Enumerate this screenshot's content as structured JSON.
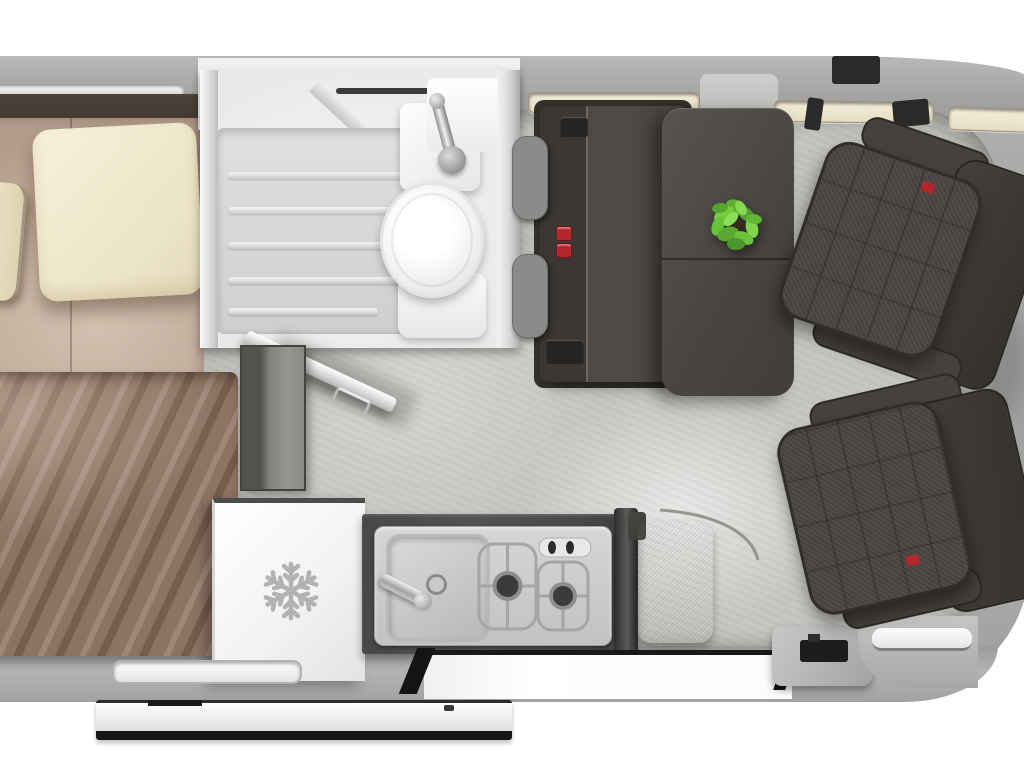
{
  "meta": {
    "title": "Campervan interior floor plan - top-down 3D render",
    "view": "top-down",
    "visible_text": "none"
  },
  "colors": {
    "bg": "#ffffff",
    "body_grey": "#a6a6a4",
    "floor": "#c6c6c2",
    "bathroom_white": "#eceae8",
    "bed_tan": "#b29c8c",
    "blanket_brown": "#8d7363",
    "pillow_cream": "#f2ebd2",
    "headboard_brown": "#41382f",
    "charcoal_dark": "#3a3735",
    "headrest_grey": "#8d8b89",
    "counter_dark": "#4b4947",
    "steel": "#c6c6c4",
    "buckle_red": "#b5252c",
    "plant_green": "#6abf3a",
    "snowflake_grey": "#b3b2b0",
    "door_trim_black": "#1b1917"
  },
  "labels": {
    "vehicle": "campervan body shell",
    "floor": "interior floor",
    "bed": "rear double bed",
    "headboard": "bed headboard",
    "pillow": "pillow",
    "blanket": "blanket",
    "bathroom": "wet room",
    "shower": "shower tray",
    "toilet": "toilet",
    "basin": "washbasin with faucet",
    "bath_door": "open bathroom door",
    "partition": "bed-end partition panel",
    "fridge": "refrigerator (snowflake icon)",
    "counter": "kitchen worktop",
    "sink": "kitchen sink",
    "hob": "two-burner gas hob",
    "bench": "worktop end cushion",
    "sofa": "two-seat travel sofa",
    "headrest": "sofa headrest",
    "buckle": "seat-belt buckle",
    "table": "dinette table",
    "plant": "potted plant",
    "passenger_seat": "passenger swivel seat",
    "driver_seat": "driver swivel seat",
    "entry": "sliding-door opening",
    "door_panel": "sliding door panel",
    "window": "window slit",
    "step": "entry step trim"
  },
  "zones": [
    {
      "name": "bedroom",
      "contents": [
        "double bed",
        "two pillows",
        "blanket",
        "headboard"
      ]
    },
    {
      "name": "bathroom",
      "contents": [
        "shower tray",
        "toilet",
        "washbasin",
        "chrome faucet",
        "open door"
      ]
    },
    {
      "name": "kitchen",
      "contents": [
        "refrigerator",
        "stainless sink",
        "two-burner gas hob",
        "two control knobs",
        "folding faucet",
        "end cushion"
      ]
    },
    {
      "name": "lounge",
      "contents": [
        "two-seat sofa with headrests",
        "two red seat-belt buckles",
        "pedestal table",
        "green plant"
      ]
    },
    {
      "name": "cab",
      "contents": [
        "driver swivel seat",
        "passenger swivel seat"
      ]
    },
    {
      "name": "entry",
      "contents": [
        "sliding-door opening",
        "detached sliding door",
        "door jamb",
        "cab door sill"
      ]
    }
  ],
  "icons": [
    {
      "name": "snowflake-icon",
      "meaning": "refrigerator / freezer"
    }
  ],
  "window_slits": [
    "rear-left above bed",
    "above washbasin",
    "above sofa",
    "above cab left",
    "above cab right",
    "rear-bottom below bed"
  ]
}
